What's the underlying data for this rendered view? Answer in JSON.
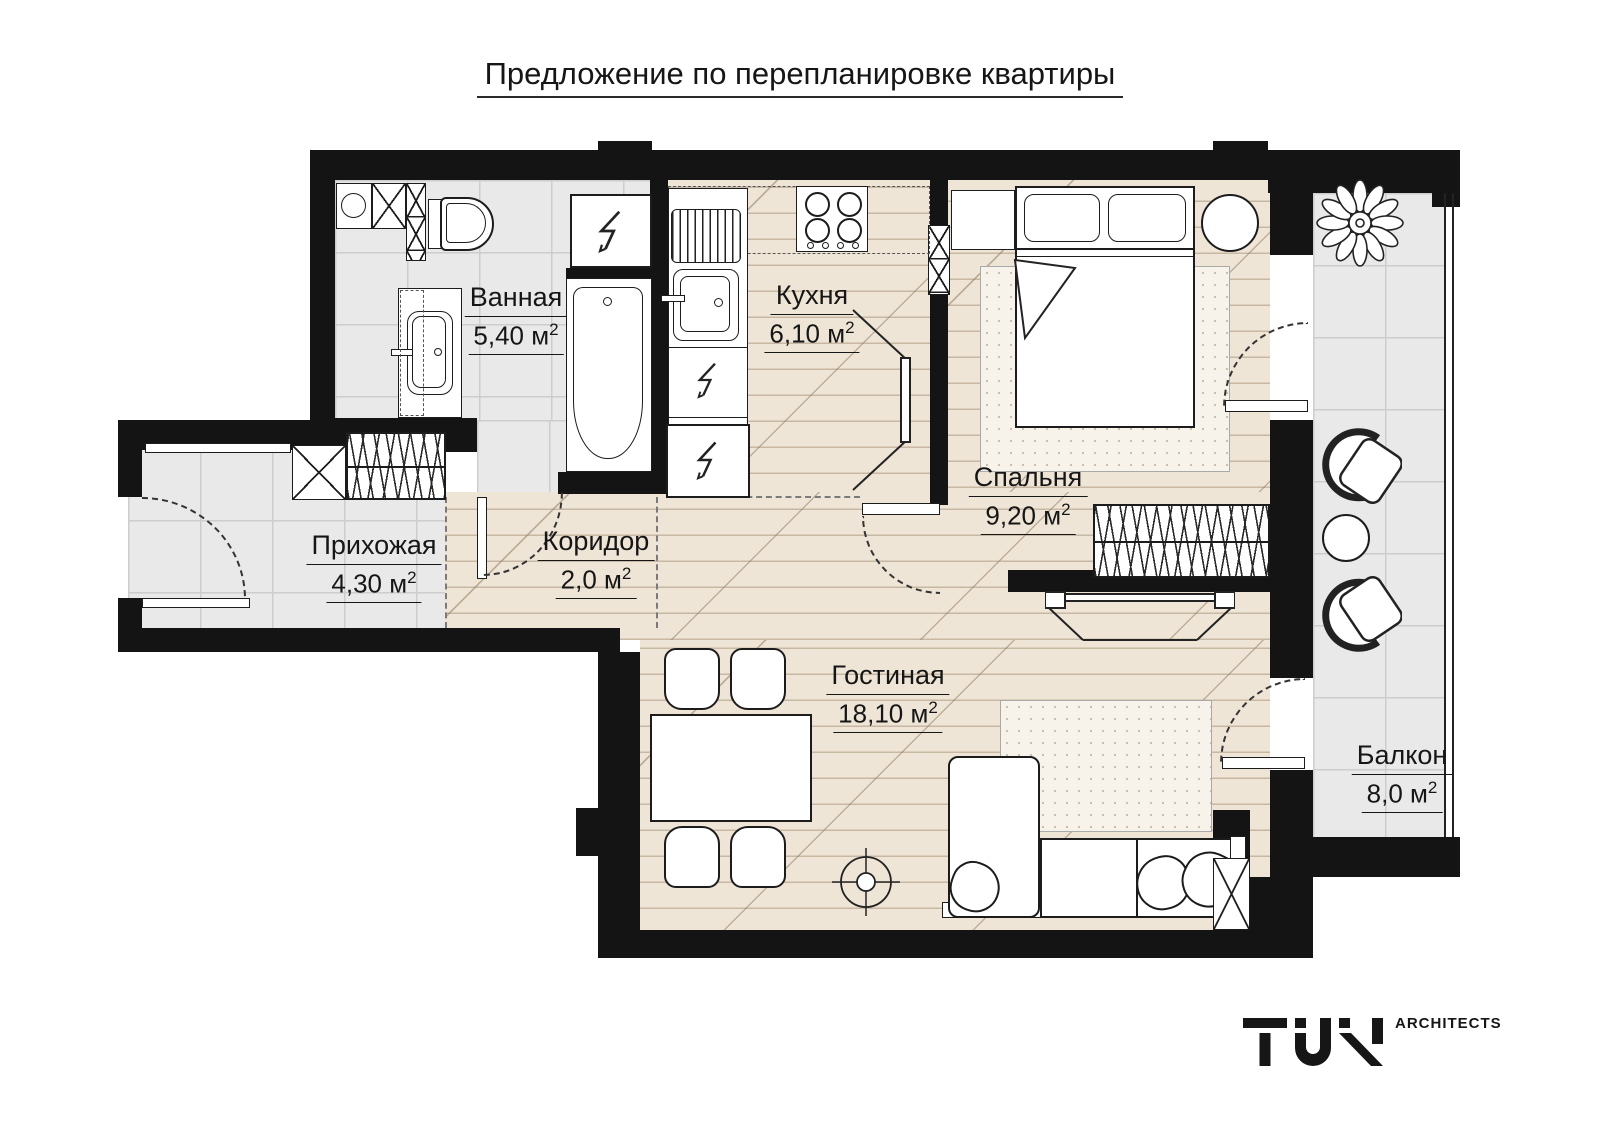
{
  "title": "Предложение по перепланировке квартиры",
  "rooms": {
    "bathroom": {
      "name": "Ванная",
      "area": "5,40 м",
      "sup": "2"
    },
    "kitchen": {
      "name": "Кухня",
      "area": "6,10 м",
      "sup": "2"
    },
    "bedroom": {
      "name": "Спальня",
      "area": "9,20 м",
      "sup": "2"
    },
    "hallway": {
      "name": "Прихожая",
      "area": "4,30 м",
      "sup": "2"
    },
    "corridor": {
      "name": "Коридор",
      "area": "2,0 м",
      "sup": "2"
    },
    "living": {
      "name": "Гостиная",
      "area": "18,10 м",
      "sup": "2"
    },
    "balcony": {
      "name": "Балкон",
      "area": "8,0 м",
      "sup": "2"
    }
  },
  "logo": {
    "brand": "TUN",
    "suffix": "ARCHITECTS"
  },
  "colors": {
    "wall": "#141414",
    "tile": "#e9e9e9",
    "wood": "#efe5d7",
    "line": "#1c1c1c"
  }
}
